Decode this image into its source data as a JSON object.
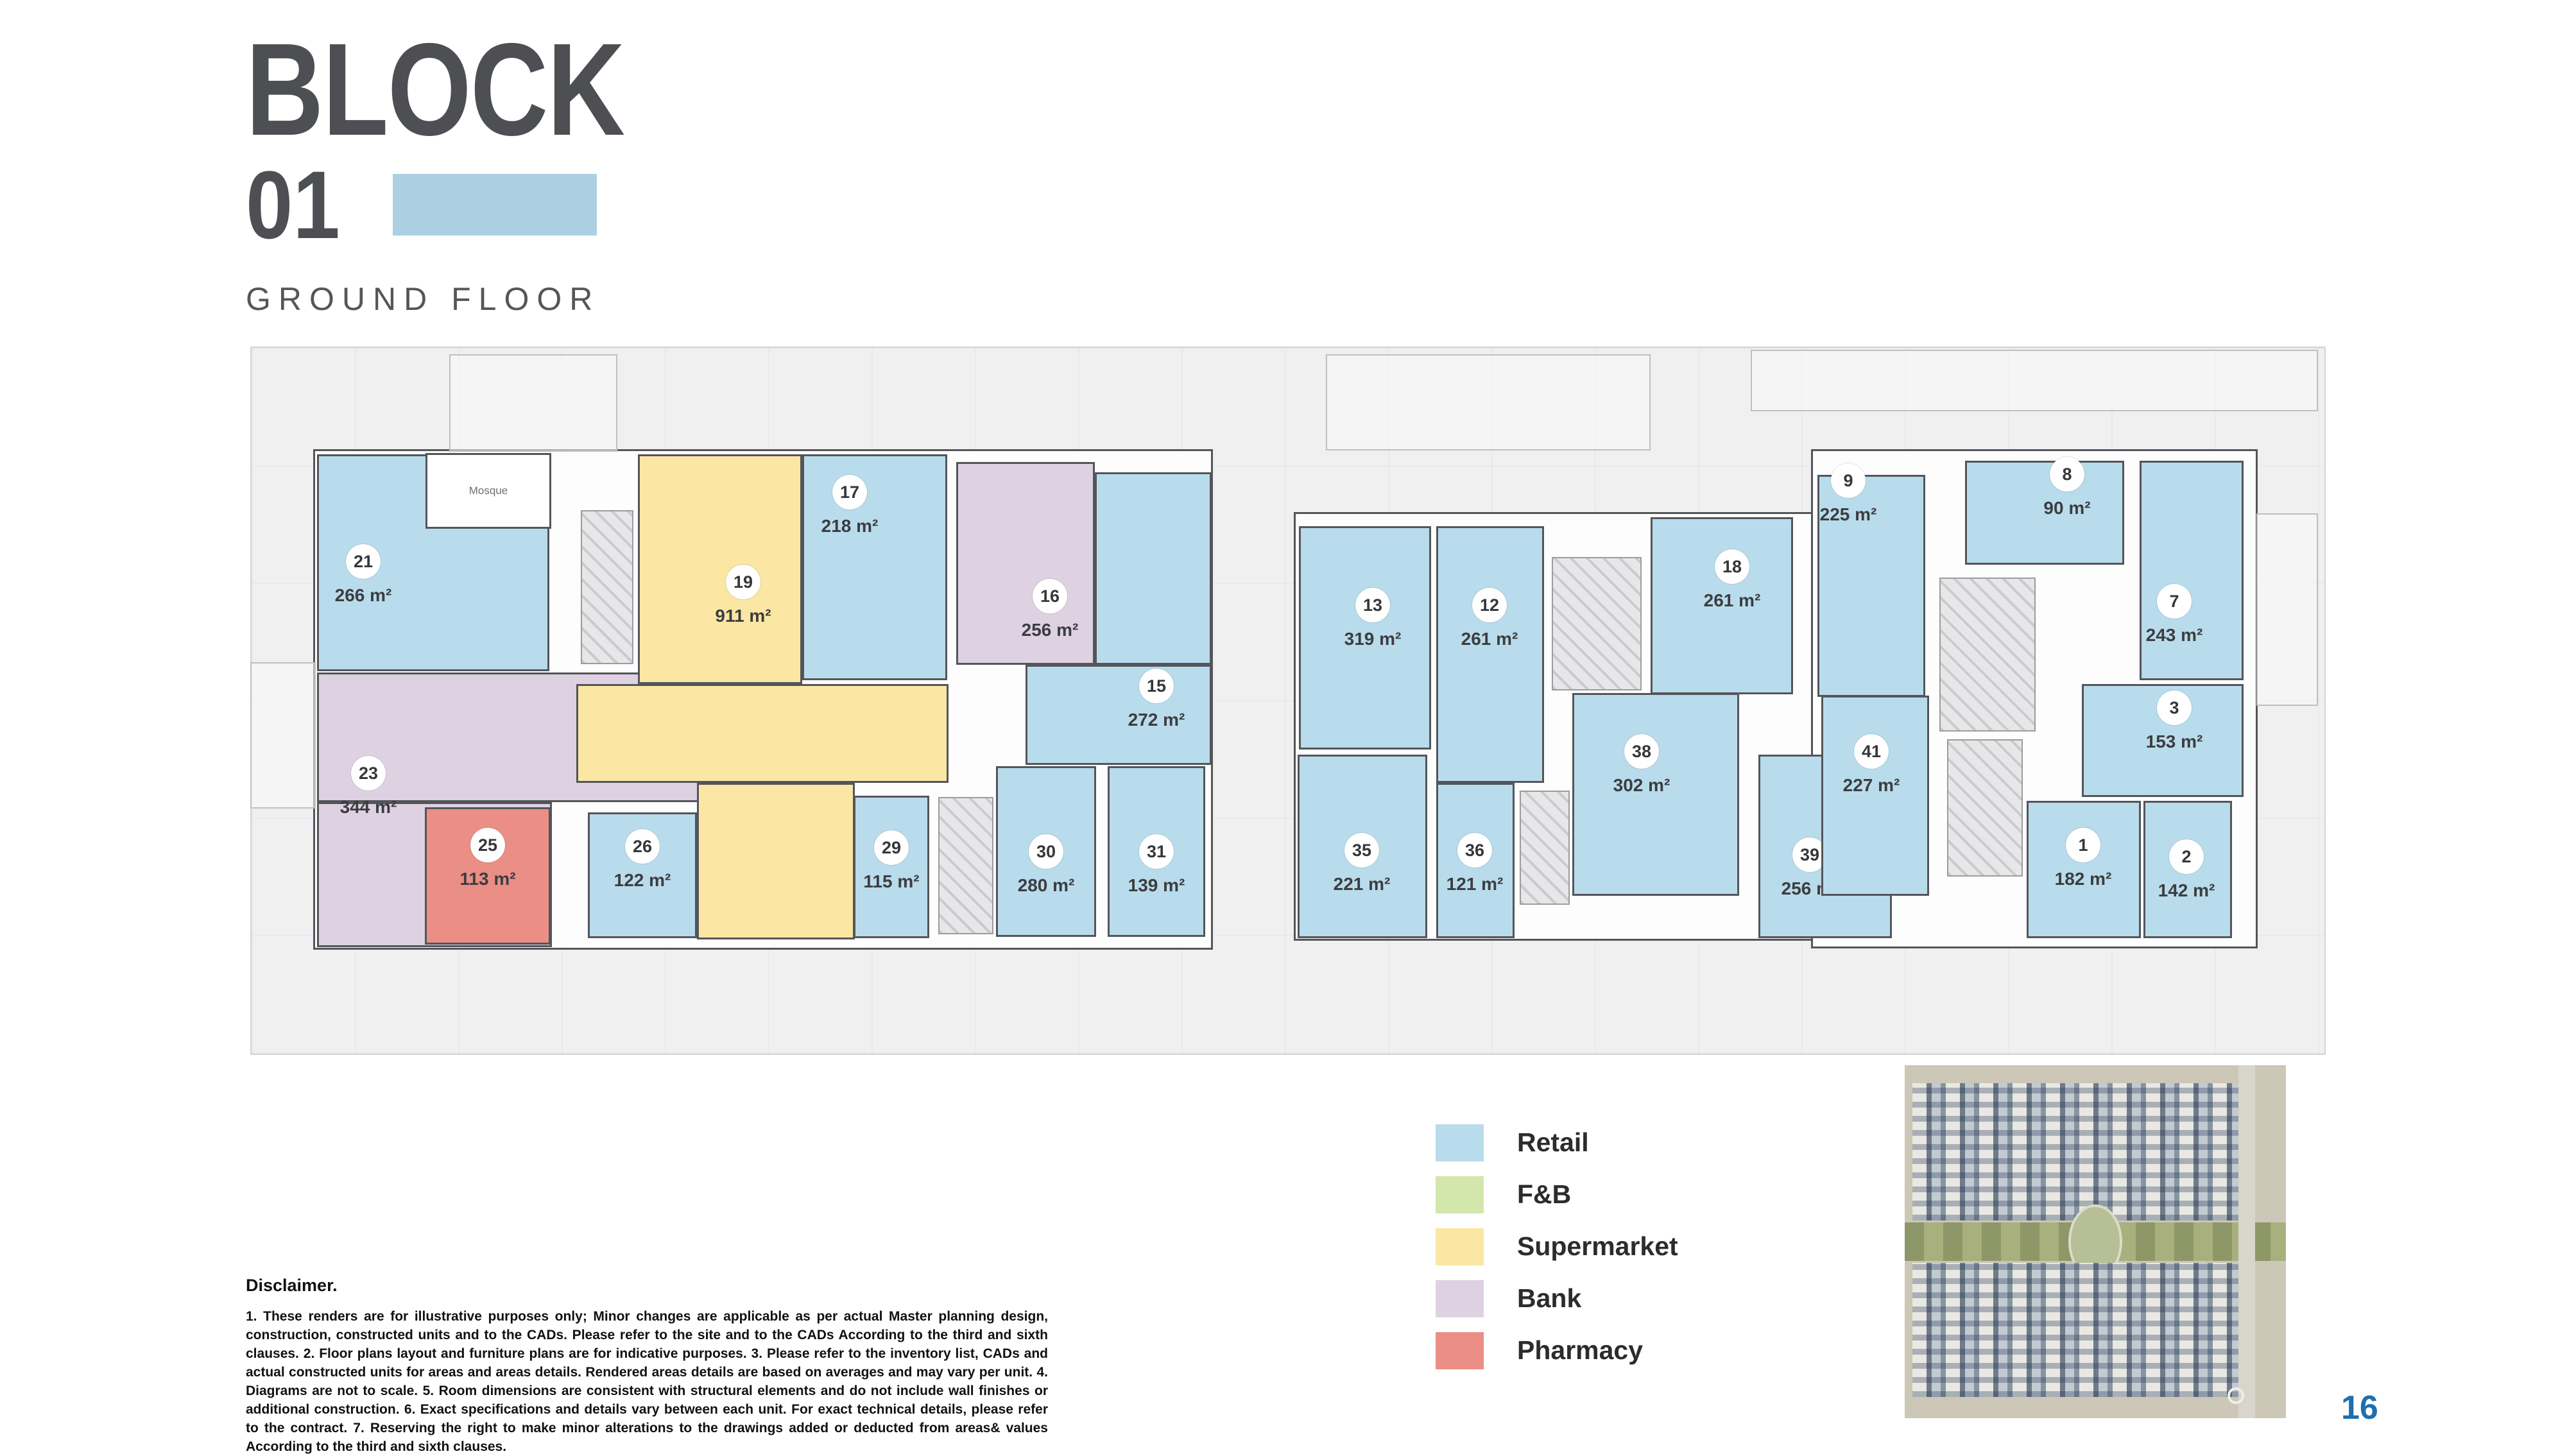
{
  "page": {
    "title_line1": "BLOCK",
    "title_line2": "01",
    "subtitle": "GROUND FLOOR",
    "page_number": "16"
  },
  "colors": {
    "retail": "#b9dcec",
    "fnb": "#d3e7ac",
    "supermarket": "#fbe7a3",
    "bank": "#ded2e2",
    "pharmacy": "#ea8e86",
    "wall": "#54555a",
    "title_gray": "#4e4f53",
    "swatch_blue": "#accfe1",
    "page_number_blue": "#1e6fae"
  },
  "legend": {
    "items": [
      {
        "label": "Retail",
        "key": "retail"
      },
      {
        "label": "F&B",
        "key": "fnb"
      },
      {
        "label": "Supermarket",
        "key": "supermarket"
      },
      {
        "label": "Bank",
        "key": "bank"
      },
      {
        "label": "Pharmacy",
        "key": "pharmacy"
      }
    ]
  },
  "plan": {
    "mosque_label": "Mosque",
    "mosque": [
      663,
      706,
      196,
      118
    ],
    "units": [
      {
        "number": "21",
        "area": "266 m²",
        "category": "retail",
        "parts": [
          [
            494,
            708,
            362,
            338
          ]
        ],
        "label": [
          566,
          896
        ]
      },
      {
        "number": "23",
        "area": "344 m²",
        "category": "bank",
        "parts": [
          [
            494,
            1048,
            696,
            202
          ],
          [
            494,
            1250,
            366,
            226
          ]
        ],
        "label": [
          574,
          1226
        ]
      },
      {
        "number": "25",
        "area": "113 m²",
        "category": "pharmacy",
        "parts": [
          [
            662,
            1258,
            196,
            214
          ]
        ],
        "label": [
          760,
          1338
        ]
      },
      {
        "number": "19",
        "area": "911 m²",
        "category": "supermarket",
        "parts": [
          [
            994,
            708,
            256,
            358
          ],
          [
            898,
            1066,
            580,
            154
          ],
          [
            1086,
            1220,
            246,
            244
          ]
        ],
        "label": [
          1158,
          928
        ]
      },
      {
        "number": "26",
        "area": "122 m²",
        "category": "retail",
        "parts": [
          [
            916,
            1266,
            170,
            196
          ]
        ],
        "label": [
          1001,
          1340
        ]
      },
      {
        "number": "29",
        "area": "115 m²",
        "category": "retail",
        "parts": [
          [
            1330,
            1240,
            118,
            222
          ]
        ],
        "label": [
          1389,
          1342
        ]
      },
      {
        "number": "17",
        "area": "218 m²",
        "category": "retail",
        "parts": [
          [
            1250,
            708,
            226,
            352
          ]
        ],
        "label": [
          1324,
          788
        ]
      },
      {
        "number": "16",
        "area": "256 m²",
        "category": "bank",
        "parts": [
          [
            1490,
            720,
            216,
            316
          ]
        ],
        "label": [
          1636,
          950
        ]
      },
      {
        "number": "15",
        "area": "272 m²",
        "category": "retail",
        "parts": [
          [
            1706,
            736,
            182,
            300
          ],
          [
            1598,
            1036,
            290,
            156
          ]
        ],
        "label": [
          1802,
          1090
        ]
      },
      {
        "number": "30",
        "area": "280 m²",
        "category": "retail",
        "parts": [
          [
            1552,
            1194,
            156,
            266
          ]
        ],
        "label": [
          1630,
          1348
        ]
      },
      {
        "number": "31",
        "area": "139 m²",
        "category": "retail",
        "parts": [
          [
            1726,
            1194,
            152,
            266
          ]
        ],
        "label": [
          1802,
          1348
        ]
      },
      {
        "number": "13",
        "area": "319 m²",
        "category": "retail",
        "parts": [
          [
            2024,
            820,
            206,
            348
          ]
        ],
        "label": [
          2139,
          964
        ]
      },
      {
        "number": "12",
        "area": "261 m²",
        "category": "retail",
        "parts": [
          [
            2238,
            820,
            168,
            400
          ]
        ],
        "label": [
          2321,
          964
        ]
      },
      {
        "number": "18",
        "area": "261 m²",
        "category": "retail",
        "parts": [
          [
            2572,
            806,
            222,
            276
          ]
        ],
        "label": [
          2699,
          904
        ]
      },
      {
        "number": "35",
        "area": "221 m²",
        "category": "retail",
        "parts": [
          [
            2022,
            1176,
            202,
            286
          ]
        ],
        "label": [
          2122,
          1346
        ]
      },
      {
        "number": "36",
        "area": "121 m²",
        "category": "retail",
        "parts": [
          [
            2238,
            1220,
            122,
            242
          ]
        ],
        "label": [
          2298,
          1346
        ]
      },
      {
        "number": "38",
        "area": "302 m²",
        "category": "retail",
        "parts": [
          [
            2450,
            1080,
            260,
            316
          ]
        ],
        "label": [
          2558,
          1192
        ]
      },
      {
        "number": "39",
        "area": "256 m²",
        "category": "retail",
        "parts": [
          [
            2740,
            1176,
            208,
            286
          ]
        ],
        "label": [
          2820,
          1353
        ]
      },
      {
        "number": "41",
        "area": "227 m²",
        "category": "retail",
        "parts": [
          [
            2838,
            1084,
            168,
            312
          ]
        ],
        "label": [
          2916,
          1192
        ]
      },
      {
        "number": "9",
        "area": "225 m²",
        "category": "retail",
        "parts": [
          [
            2832,
            740,
            168,
            346
          ]
        ],
        "label": [
          2880,
          770
        ]
      },
      {
        "number": "8",
        "area": "90 m²",
        "category": "retail",
        "parts": [
          [
            3062,
            718,
            248,
            162
          ]
        ],
        "label": [
          3221,
          760
        ]
      },
      {
        "number": "7",
        "area": "243 m²",
        "category": "retail",
        "parts": [
          [
            3334,
            718,
            162,
            342
          ]
        ],
        "label": [
          3388,
          958
        ]
      },
      {
        "number": "3",
        "area": "153 m²",
        "category": "retail",
        "parts": [
          [
            3244,
            1066,
            252,
            176
          ]
        ],
        "label": [
          3388,
          1124
        ]
      },
      {
        "number": "1",
        "area": "182 m²",
        "category": "retail",
        "parts": [
          [
            3158,
            1248,
            178,
            214
          ]
        ],
        "label": [
          3246,
          1338
        ]
      },
      {
        "number": "2",
        "area": "142 m²",
        "category": "retail",
        "parts": [
          [
            3340,
            1248,
            138,
            214
          ]
        ],
        "label": [
          3407,
          1356
        ]
      }
    ],
    "footprints": [
      [
        488,
        700,
        1402,
        780
      ],
      [
        2016,
        798,
        996,
        668
      ],
      [
        2822,
        700,
        696,
        778
      ]
    ],
    "cores": [
      [
        905,
        795,
        82,
        240
      ],
      [
        1462,
        1242,
        86,
        214
      ],
      [
        2418,
        868,
        140,
        208
      ],
      [
        2368,
        1232,
        78,
        178
      ],
      [
        3022,
        900,
        150,
        240
      ],
      [
        3034,
        1152,
        118,
        214
      ]
    ],
    "outlines": [
      [
        700,
        552,
        262,
        152
      ],
      [
        2066,
        552,
        506,
        150
      ],
      [
        2728,
        545,
        884,
        96
      ],
      [
        390,
        1032,
        102,
        228
      ],
      [
        3516,
        800,
        96,
        300
      ]
    ]
  },
  "disclaimer": {
    "heading": "Disclaimer.",
    "body": "1. These renders are for illustrative purposes only; Minor changes are applicable as per actual Master planning design, construction, constructed units and to the CADs. Please refer to the site and to the CADs According to the third and sixth clauses. 2. Floor plans layout and furniture plans are for indicative purposes. 3. Please refer to the inventory list, CADs and actual constructed units for areas and areas details. Rendered areas details are based on averages and may vary per unit. 4. Diagrams are not to scale. 5. Room dimensions are consistent with structural elements and do not include wall finishes or additional construction. 6. Exact specifications and details vary between each unit. For exact technical details, please refer to the contract. 7. Reserving the right to make minor alterations to the drawings added or deducted from areas& values According to the third and sixth clauses."
  }
}
